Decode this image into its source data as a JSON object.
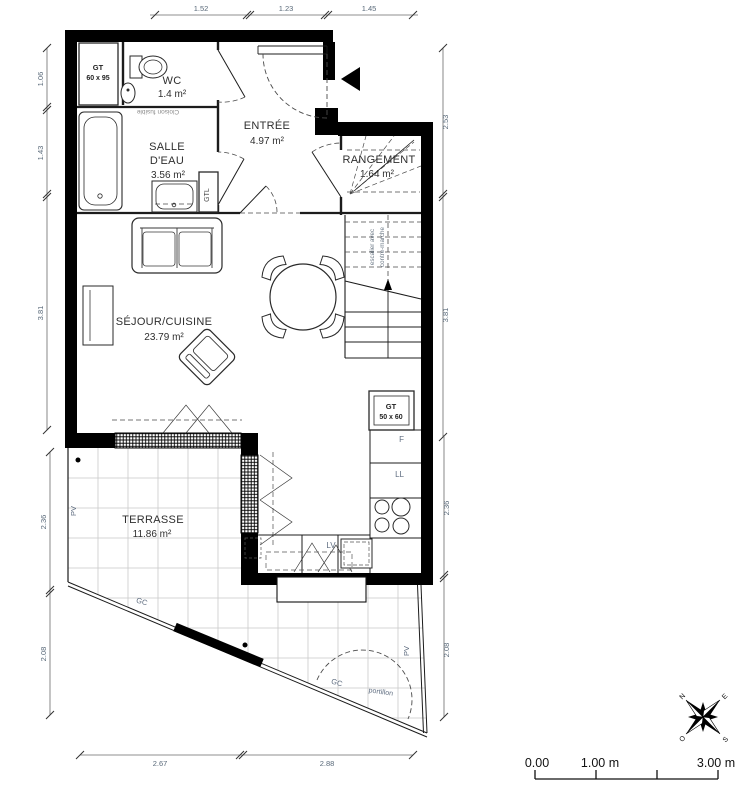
{
  "rooms": {
    "wc": {
      "name": "WC",
      "area": "1.4 m²"
    },
    "entree": {
      "name": "ENTRÉE",
      "area": "4.97 m²"
    },
    "salle_deau": {
      "line1": "SALLE",
      "line2": "D'EAU",
      "area": "3.56 m²"
    },
    "rangement": {
      "name": "RANGEMENT",
      "area": "1.64 m²"
    },
    "sejour_cuisine": {
      "name": "SÉJOUR/CUISINE",
      "area": "23.79 m²"
    },
    "terrasse": {
      "name": "TERRASSE",
      "area": "11.86 m²"
    }
  },
  "equipment": {
    "gt_wc_line1": "GT",
    "gt_wc_line2": "60 x 95",
    "gtl": "GTL",
    "gt_kitchen_line1": "GT",
    "gt_kitchen_line2": "50 x 60",
    "fridge": "F",
    "washing_machine": "LL",
    "dishwasher": "LV"
  },
  "site": {
    "pv": "PV",
    "gc": "GC",
    "portillon": "portillon"
  },
  "notes": {
    "cloison_fusible": "Cloison fusible",
    "stair_line1": "escalier avec",
    "stair_line2": "contre-marche"
  },
  "dimensions": {
    "top": [
      "1.52",
      "1.23",
      "1.45"
    ],
    "left_upper": [
      "1.06",
      "1.43",
      "3.81"
    ],
    "left_lower": [
      "2.36",
      "2.08"
    ],
    "right_upper": [
      "2.53",
      "3.81"
    ],
    "right_lower": [
      "2.36",
      "2.08"
    ],
    "bottom": [
      "2.67",
      "2.88"
    ]
  },
  "scale_bar": {
    "start": "0.00",
    "mid": "1.00 m",
    "end": "3.00 m"
  },
  "compass": {
    "north": "N",
    "east": "E",
    "south": "S",
    "west": "O"
  },
  "colors": {
    "wall": "#000000",
    "linework": "#1c1c1c",
    "dimension_text": "#5a6a7a",
    "annotation_text": "#5f6d80",
    "room_text": "#2f2f2f",
    "tile_grid": "#c9c9c9"
  }
}
